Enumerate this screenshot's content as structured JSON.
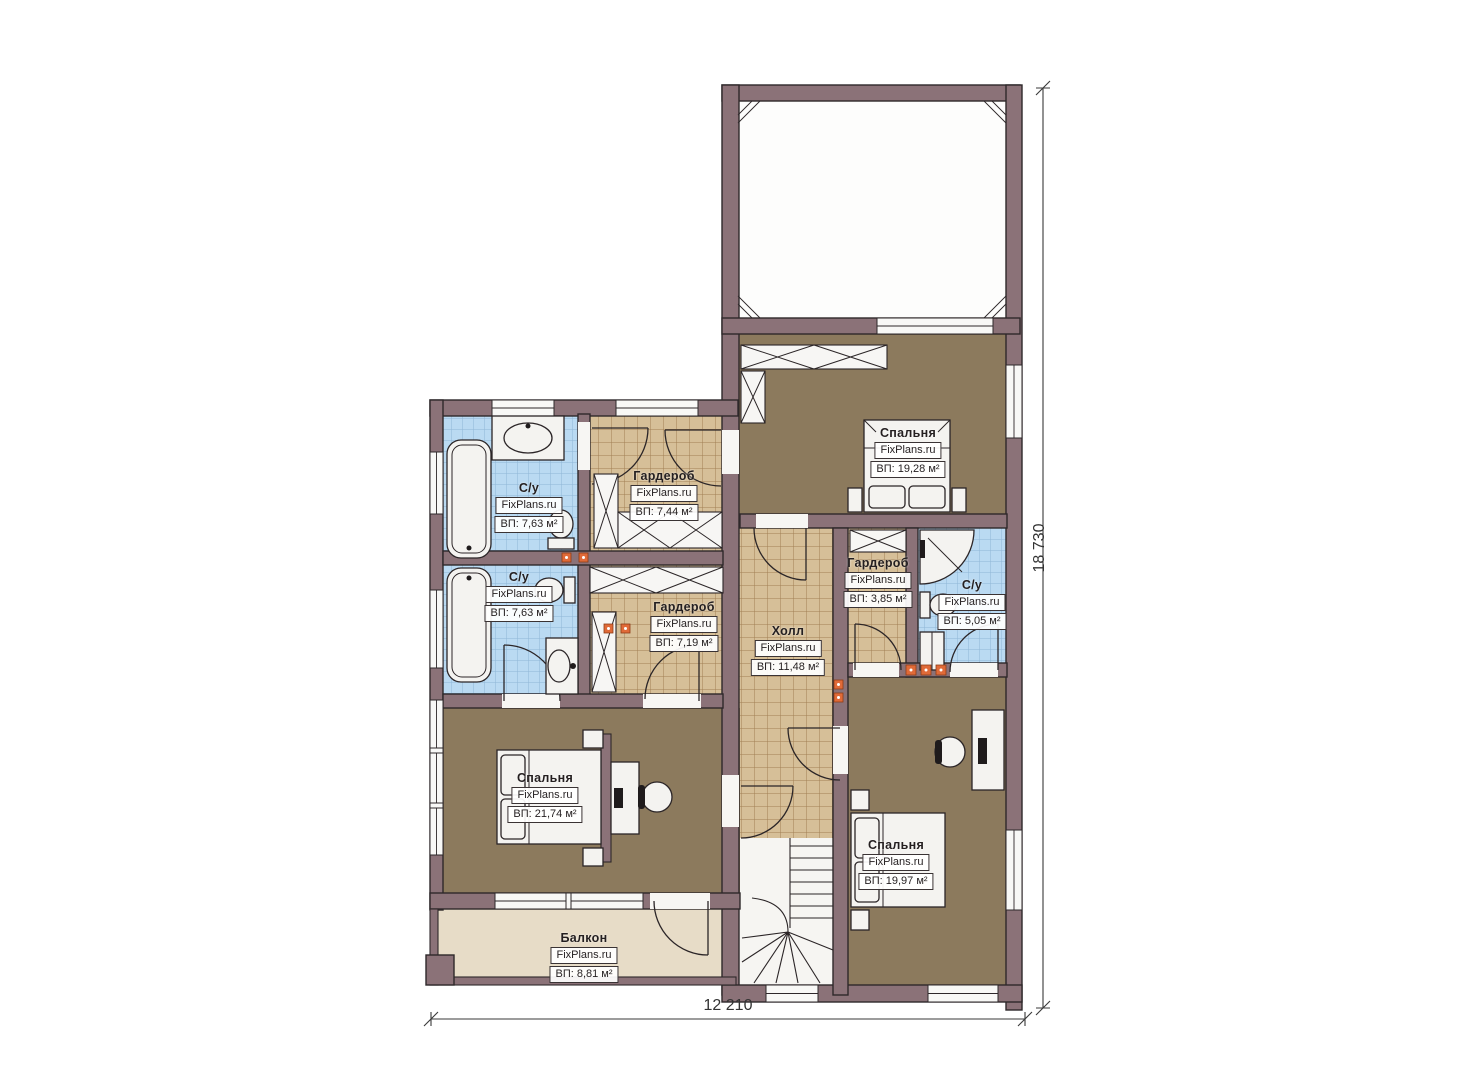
{
  "plan": {
    "title": "Floor plan (second floor)",
    "brand": "FixPlans.ru",
    "rooms": [
      {
        "name": "С/у",
        "brand": "FixPlans.ru",
        "area": "ВП: 7,63 м²"
      },
      {
        "name": "Гардероб",
        "brand": "FixPlans.ru",
        "area": "ВП: 7,44 м²"
      },
      {
        "name": "Спальня",
        "brand": "FixPlans.ru",
        "area": "ВП: 19,28 м²"
      },
      {
        "name": "С/у",
        "brand": "FixPlans.ru",
        "area": "ВП: 7,63 м²"
      },
      {
        "name": "Гардероб",
        "brand": "FixPlans.ru",
        "area": "ВП: 7,19 м²"
      },
      {
        "name": "Холл",
        "brand": "FixPlans.ru",
        "area": "ВП: 11,48 м²"
      },
      {
        "name": "Гардероб",
        "brand": "FixPlans.ru",
        "area": "ВП: 3,85 м²"
      },
      {
        "name": "С/у",
        "brand": "FixPlans.ru",
        "area": "ВП: 5,05 м²"
      },
      {
        "name": "Спальня",
        "brand": "FixPlans.ru",
        "area": "ВП: 21,74 м²"
      },
      {
        "name": "Спальня",
        "brand": "FixPlans.ru",
        "area": "ВП: 19,97 м²"
      },
      {
        "name": "Балкон",
        "brand": "FixPlans.ru",
        "area": "ВП: 8,81 м²"
      }
    ],
    "dimensions": {
      "width": "12 210",
      "height": "18 730"
    },
    "colors": {
      "wall": "#8b7278",
      "bedroom_floor": "#8c7a5d",
      "tile_floor": "#d6bf98",
      "bath_floor": "#badaf2",
      "balcony_floor": "#e7dcc7",
      "marker_accent": "#e06a38"
    }
  }
}
